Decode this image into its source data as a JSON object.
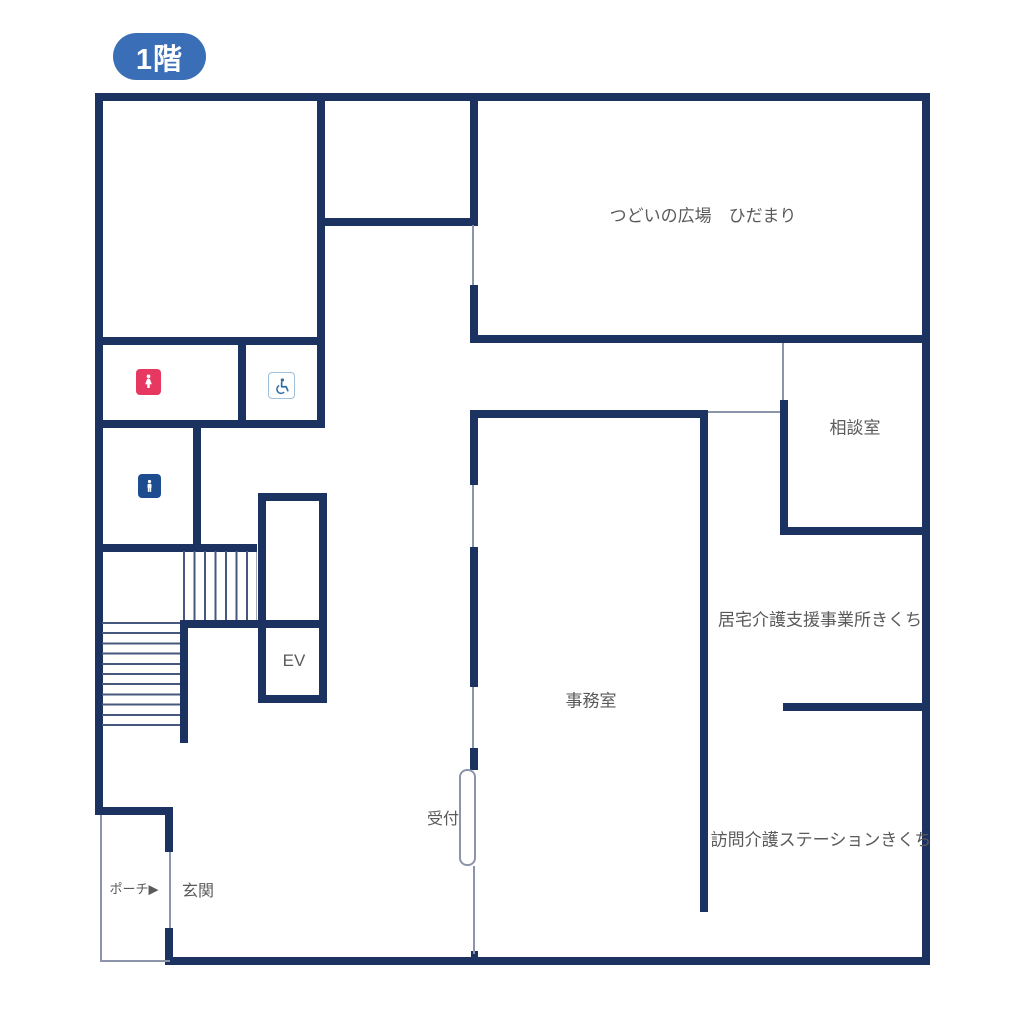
{
  "floor_badge": {
    "label": "1階"
  },
  "rooms": {
    "tsudoi": "つどいの広場　ひだまり",
    "soudan": "相談室",
    "kyotaku": "居宅介護支援事業所きくち",
    "jimu": "事務室",
    "uketsuke": "受付",
    "houmon": "訪問介護ステーションきくち",
    "ev": "EV",
    "genkan": "玄関",
    "porch": "ポーチ▶"
  },
  "icons": {
    "womens_toilet": "womens-toilet-icon",
    "mens_toilet": "mens-toilet-icon",
    "accessible_toilet": "accessible-toilet-icon"
  },
  "colors": {
    "wall": "#1c3260",
    "thin": "#8b94a8",
    "tread": "#46587e",
    "badge": "#3a6fb7",
    "text": "#5a5a5a",
    "women": "#e73862",
    "men": "#1d4c8f",
    "wheel": "#2e6da4"
  }
}
